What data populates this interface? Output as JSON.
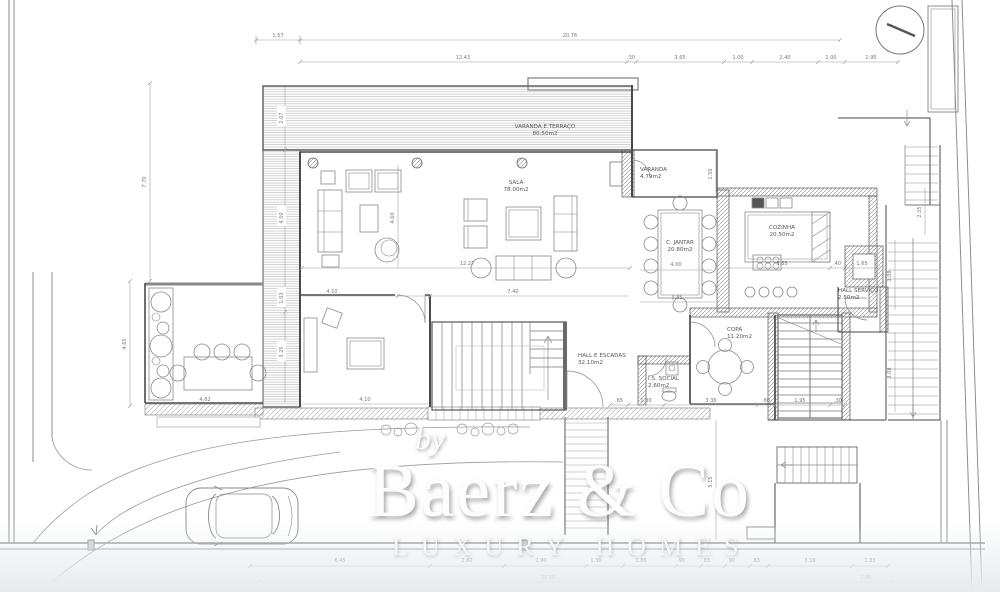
{
  "watermark": {
    "by": "by",
    "brand": "Baerz & Co",
    "tagline": "LUXURY HOMES"
  },
  "rooms": [
    {
      "name": "VARANDA E TERRAÇO",
      "area": "80.50m2"
    },
    {
      "name": "SALA",
      "area": "78.00m2"
    },
    {
      "name": "VARANDA",
      "area": "4.79m2"
    },
    {
      "name": "C. JANTAR",
      "area": "20.80m2"
    },
    {
      "name": "COZINHA",
      "area": "20.50m2"
    },
    {
      "name": "HALL SERVIÇO",
      "area": "2.50m2"
    },
    {
      "name": "HALL E ESCADAS",
      "area": "32.10m2"
    },
    {
      "name": "I.S. SOCIAL",
      "area": "2.60m2"
    },
    {
      "name": "COPA",
      "area": "11.20m2"
    }
  ],
  "dims": {
    "top1": [
      "1.57",
      "20.76"
    ],
    "top2": [
      "12.43",
      ".30",
      "3.65",
      "1.00",
      "2.40",
      "1.00",
      "1.95"
    ],
    "left": [
      "7.70",
      "4.65"
    ],
    "deck": [
      "2.07",
      "4.50",
      "1.03",
      "3.25"
    ],
    "sala": [
      "4.60",
      "12.27",
      "4.10",
      "7.40",
      "4.62",
      "4.10"
    ],
    "dining": [
      "4.00",
      "3.85"
    ],
    "veranda": [
      "1.50"
    ],
    "kitchen": [
      "3.85",
      ".40",
      "1.65"
    ],
    "right": [
      "2.25",
      "3.08",
      "3.08"
    ],
    "hall": [
      ".65",
      "1.30",
      "3.36",
      ".60",
      "1.95",
      ".30"
    ],
    "entry": [
      "5.15"
    ],
    "bottom1": [
      "6.45",
      "2.60",
      "2.90",
      "1.30",
      "1.86",
      ".90",
      ".83",
      ".90",
      ".83",
      "3.16",
      "1.33"
    ],
    "bottom2": [
      "22.35",
      "1.80"
    ]
  }
}
